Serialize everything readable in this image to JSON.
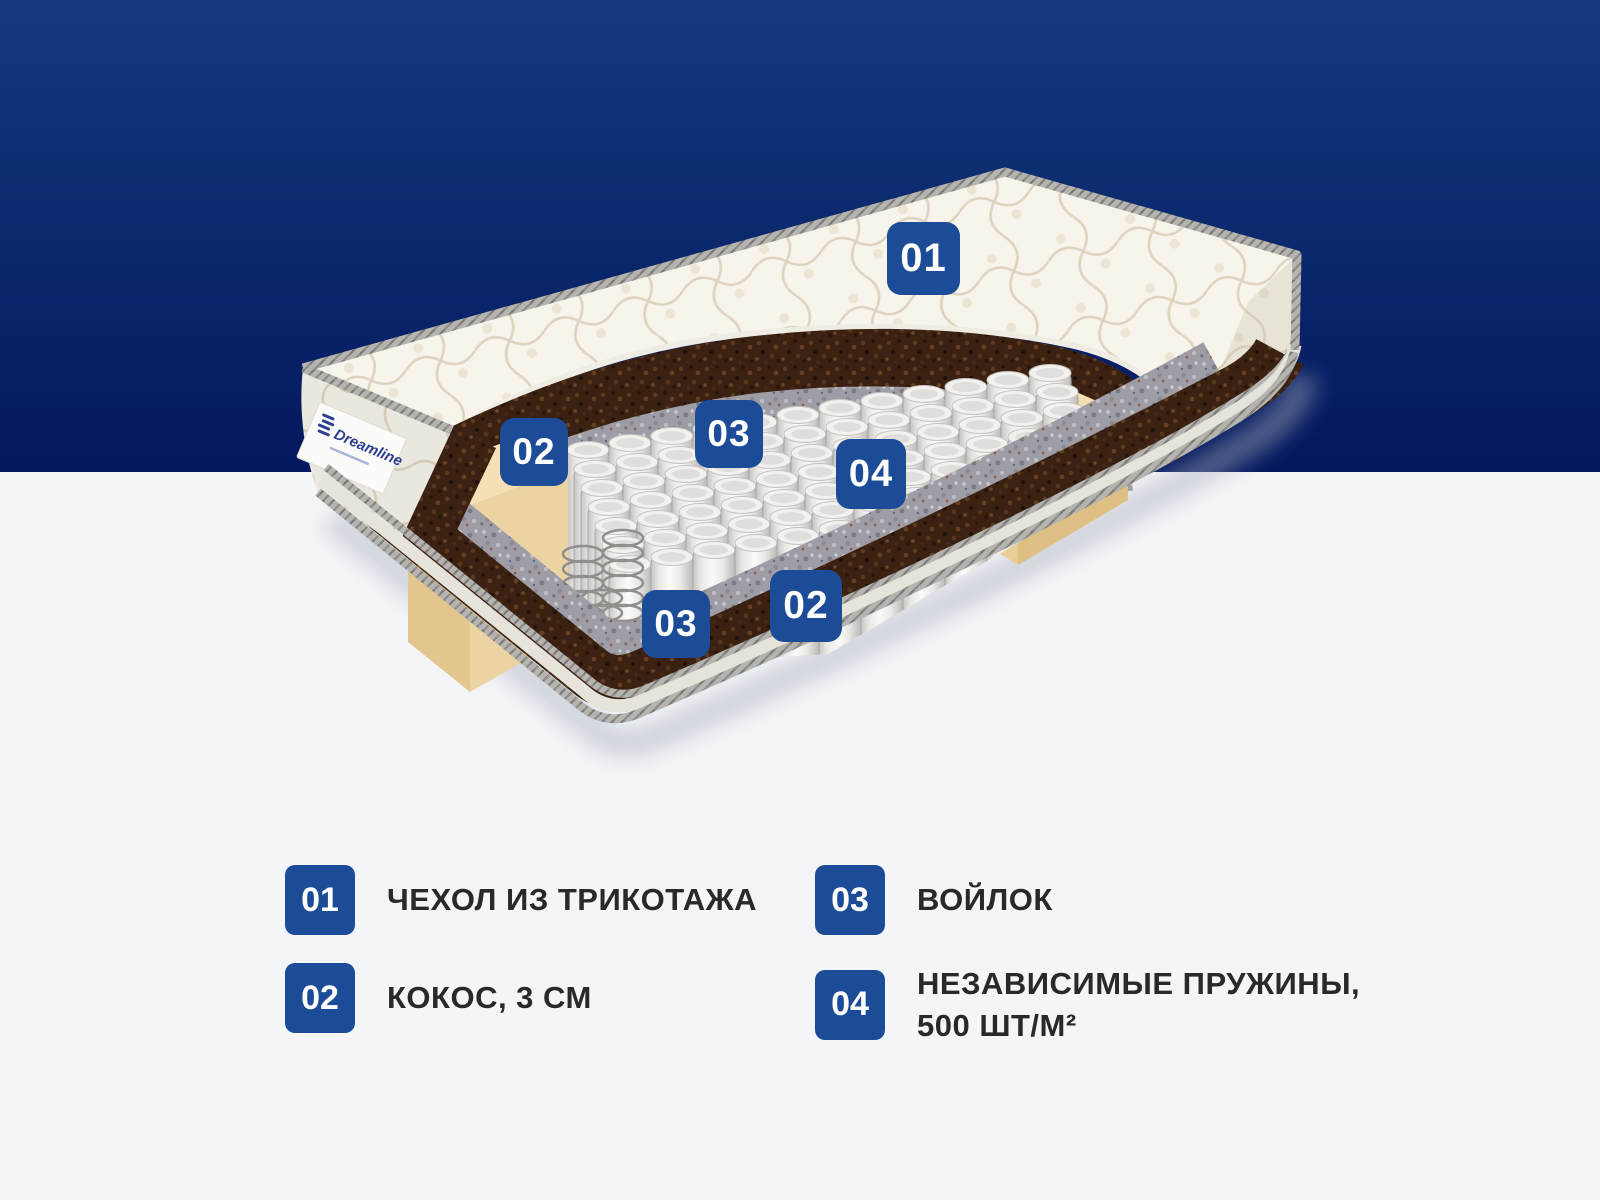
{
  "brand": {
    "label_logo_text": "Dreamline"
  },
  "colors": {
    "badge-blue": "#1c4b97",
    "bg-top-start": "#143a7d",
    "bg-top-end": "#03185e",
    "bg-bottom": "#f3f5f8",
    "text-dark": "#29292b",
    "brand-blue": "#2e3f92"
  },
  "diagram": {
    "badges": [
      {
        "label": "01"
      },
      {
        "label": "02"
      },
      {
        "label": "03"
      },
      {
        "label": "04"
      },
      {
        "label": "03"
      },
      {
        "label": "02"
      }
    ]
  },
  "legend": {
    "items": [
      {
        "number": "01",
        "label": "ЧЕХОЛ ИЗ ТРИКОТАЖА"
      },
      {
        "number": "02",
        "label": "КОКОС, 3 СМ"
      },
      {
        "number": "03",
        "label": "ВОЙЛОК"
      },
      {
        "number": "04",
        "label": "НЕЗАВИСИМЫЕ ПРУЖИНЫ, 500 ШТ/М²"
      }
    ]
  }
}
